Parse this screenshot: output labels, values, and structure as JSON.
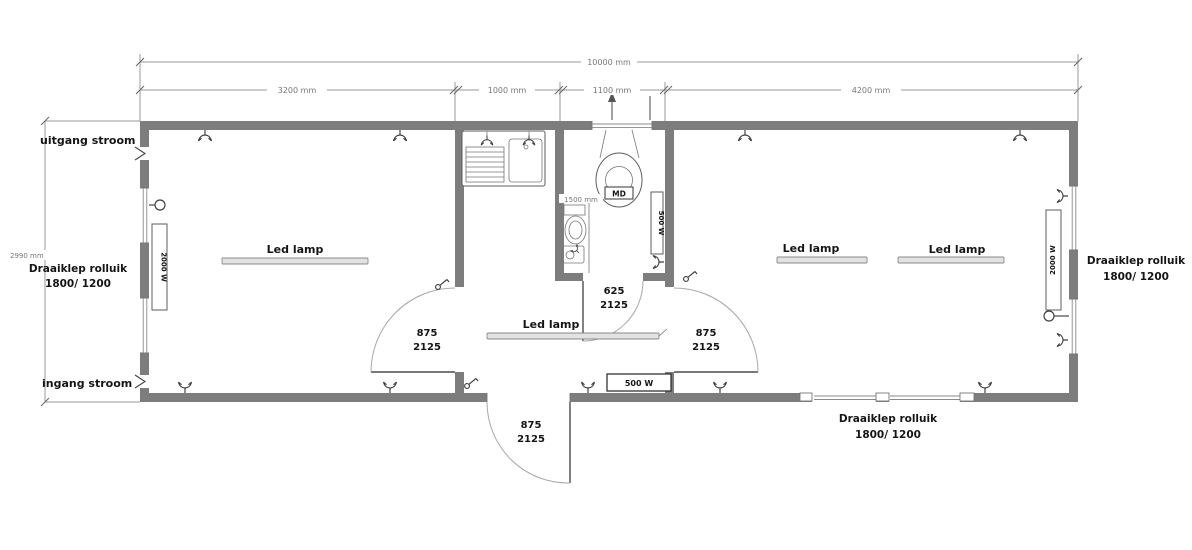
{
  "drawing": {
    "type": "container floor plan",
    "dims": {
      "total": "10000 mm",
      "seg_left_room": "3200 mm",
      "seg_kitchen": "1000 mm",
      "seg_toilet": "1100 mm",
      "seg_right_room": "4200 mm",
      "depth": "2990 mm",
      "toilet_inner": "1500 mm"
    },
    "labels": {
      "power_out": "uitgang stroom",
      "power_in": "ingang stroom",
      "shutter_l1": "Draaiklep rolluik",
      "shutter_l2": "1800/ 1200",
      "led_lamp": "Led lamp",
      "vent": "MD"
    },
    "equipment": {
      "heater_2000": "2000 W",
      "heater_500": "500 W"
    },
    "doors": {
      "w875": "875",
      "w625": "625",
      "h2125": "2125"
    },
    "colors": {
      "wall": "#7d7d7d",
      "line": "#9a9a9a",
      "text": "#151515"
    }
  }
}
